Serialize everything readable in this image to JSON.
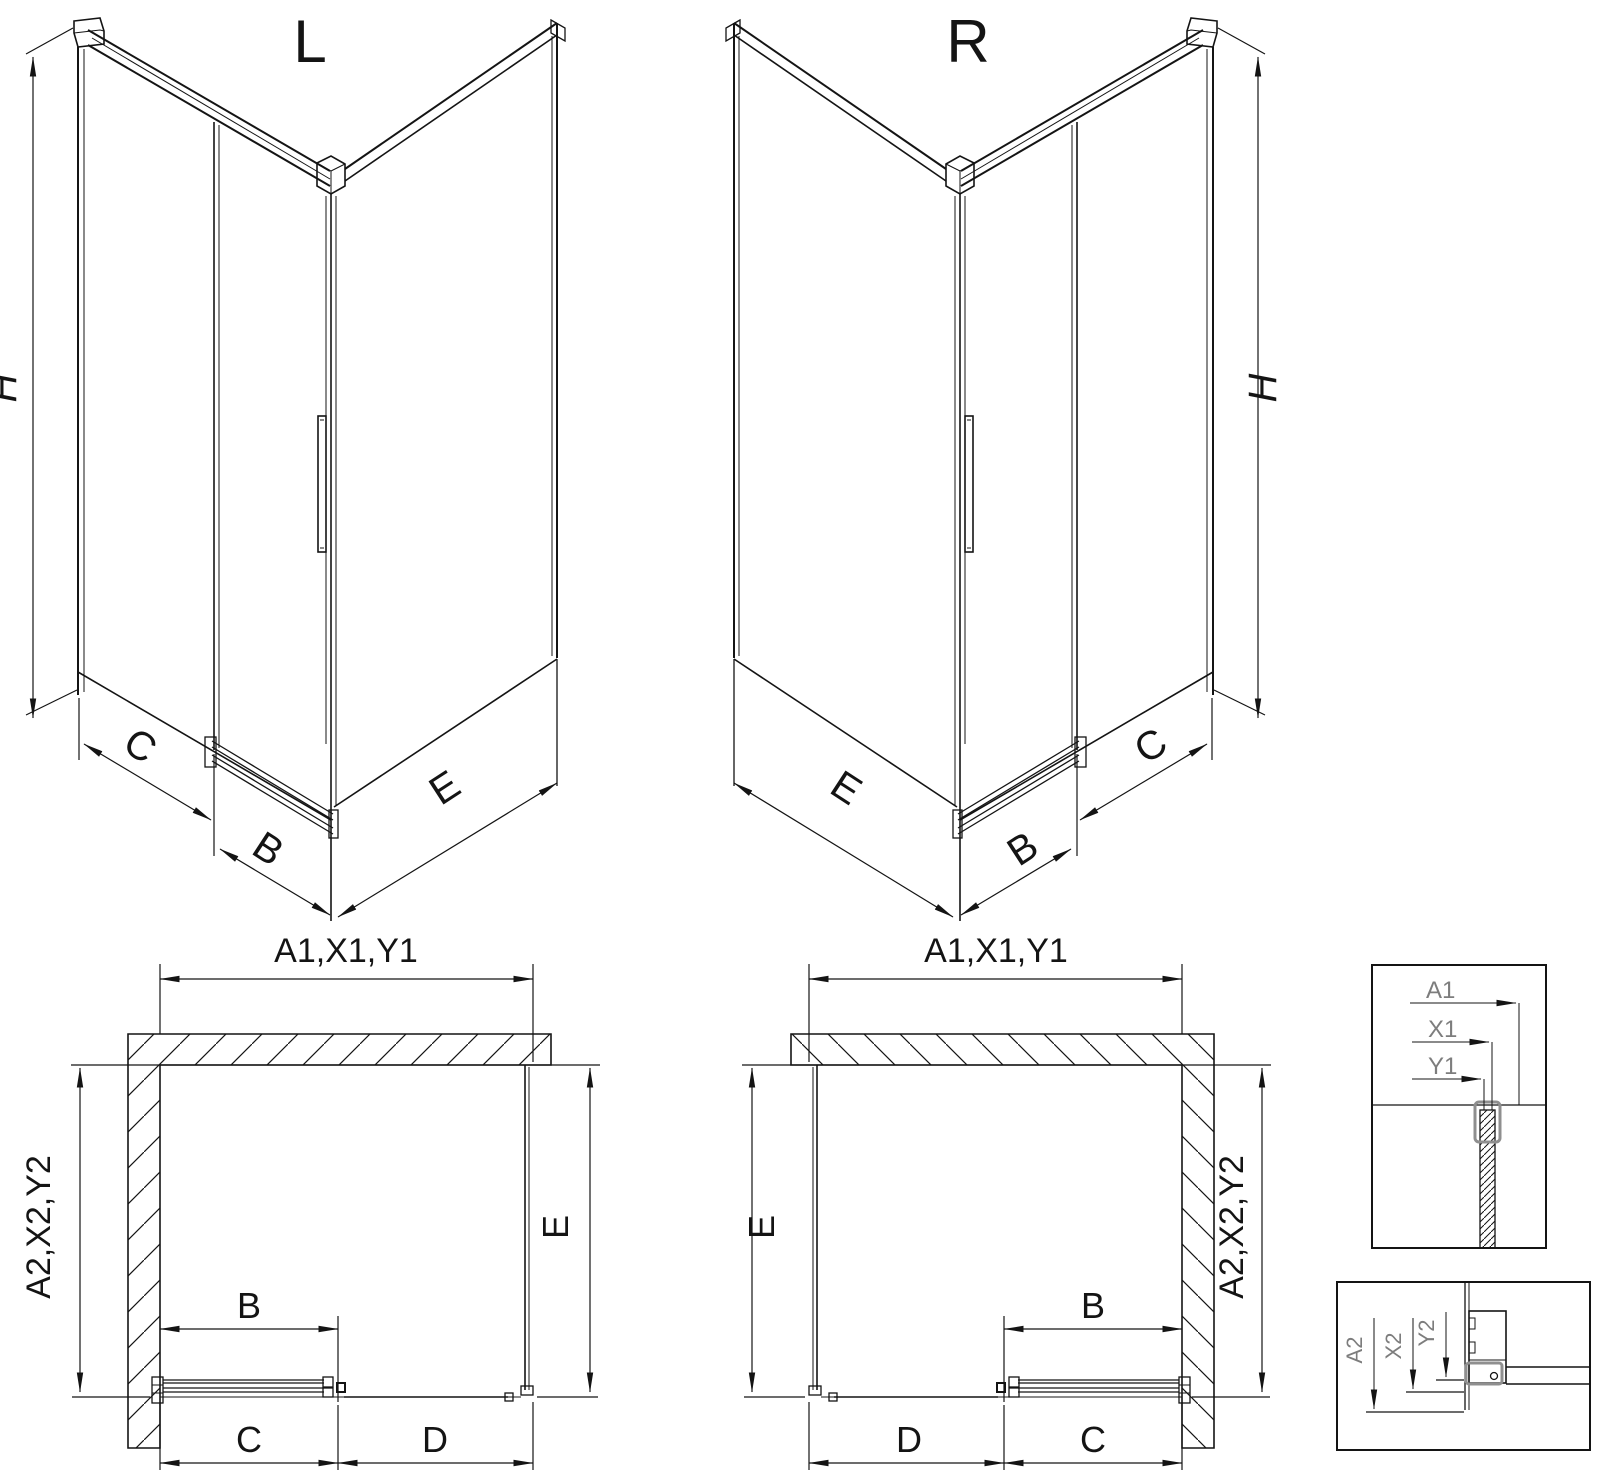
{
  "views": {
    "iso_left": {
      "title": "L",
      "dim_height": "H",
      "dim_side": "C",
      "dim_door": "B",
      "dim_return": "E"
    },
    "iso_right": {
      "title": "R",
      "dim_height": "H",
      "dim_side": "C",
      "dim_door": "B",
      "dim_return": "E"
    },
    "plan_left": {
      "dim_width": "A1,X1,Y1",
      "dim_depth": "A2,X2,Y2",
      "dim_return": "E",
      "dim_door": "B",
      "dim_fixed": "C",
      "dim_opening": "D"
    },
    "plan_right": {
      "dim_width": "A1,X1,Y1",
      "dim_depth": "A2,X2,Y2",
      "dim_return": "E",
      "dim_door": "B",
      "dim_fixed": "C",
      "dim_opening": "D"
    },
    "detail_width": {
      "dim_a": "A1",
      "dim_x": "X1",
      "dim_y": "Y1"
    },
    "detail_depth": {
      "dim_a": "A2",
      "dim_x": "X2",
      "dim_y": "Y2"
    }
  },
  "colors": {
    "line": "#141414",
    "detail_accent": "#8f8f8f",
    "detail_label": "#7d7d7d",
    "background": "#ffffff"
  }
}
